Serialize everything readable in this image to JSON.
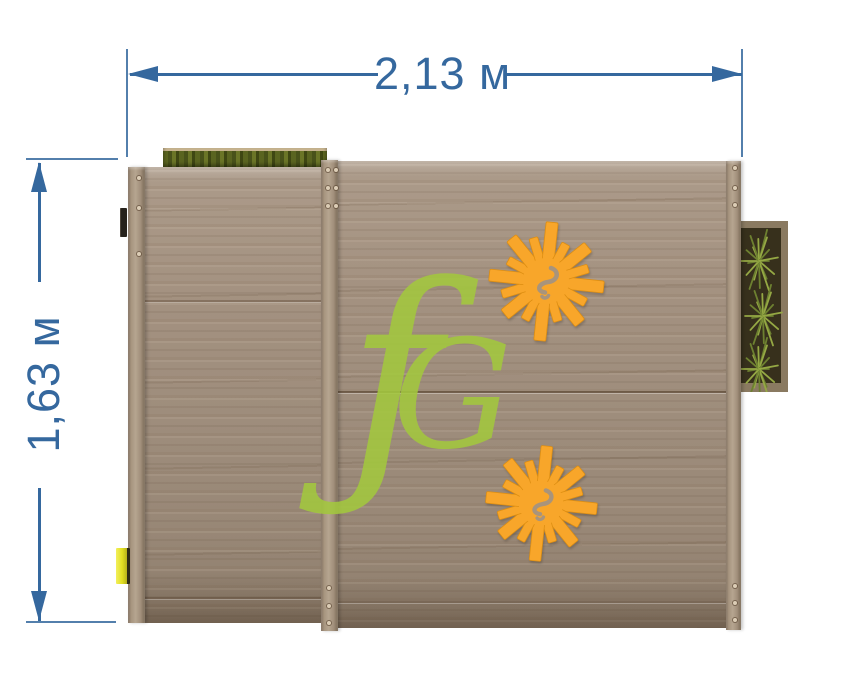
{
  "dimensions": {
    "width": {
      "label": "2,13 м"
    },
    "height": {
      "label": "1,63 м"
    }
  },
  "watermark": {
    "glyph_f": "ƒ",
    "glyph_g": "G"
  },
  "decals": {
    "sun_top": "sun-decal",
    "sun_bottom": "sun-decal",
    "watermark": "fG brand watermark"
  },
  "colors": {
    "dimension": "#35689e",
    "wood_base": "#a29180",
    "wood_light": "#b6a590",
    "wood_dark": "#786854",
    "sun_orange": "#f8a62a",
    "sun_shadow": "#dd8e12",
    "sun_glyph": "#a8947c",
    "logo_green": "#a3c83e",
    "plant_green": "#6d8030",
    "plant_green_light": "#95a844",
    "soil_dark": "#37301c",
    "planter_frame": "#8a7a61",
    "latch_yellow": "#e2df22"
  }
}
